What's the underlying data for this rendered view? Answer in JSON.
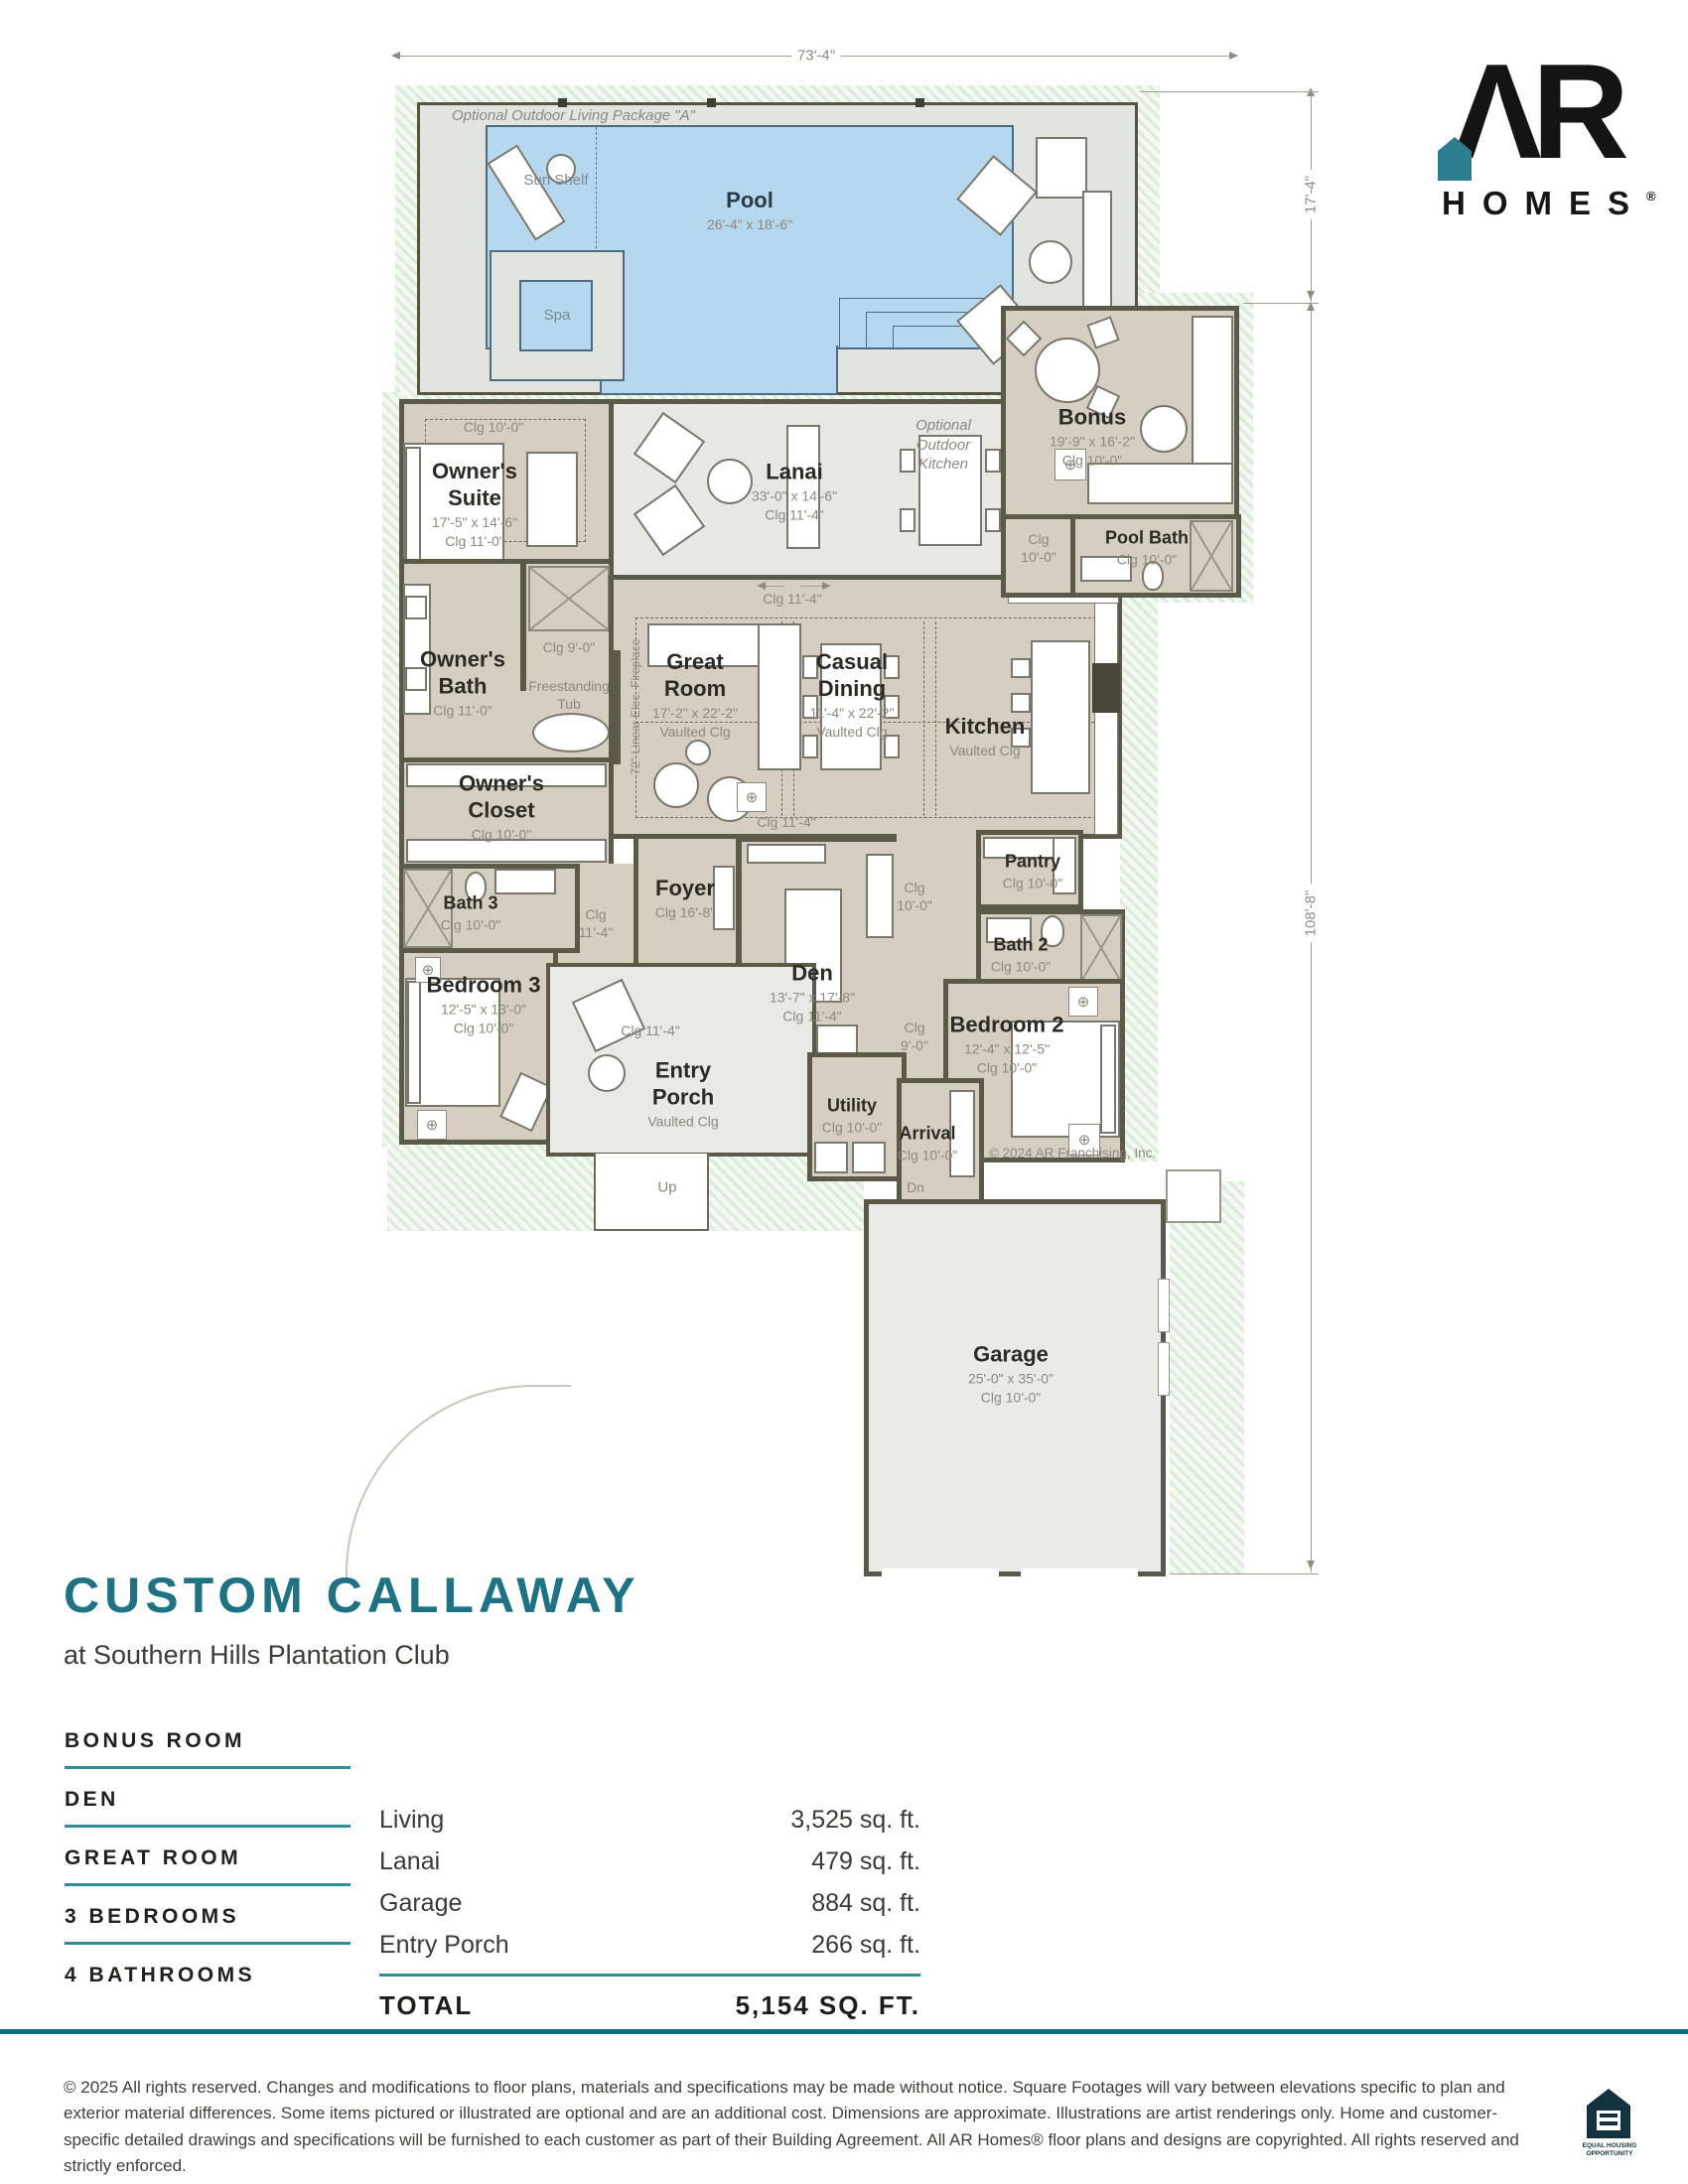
{
  "brand": {
    "monogram": "ΛR",
    "word": "HOMES",
    "registered": "®"
  },
  "dimensions": {
    "top": "73'-4\"",
    "right_upper": "17'-4\"",
    "right_lower": "108'-8\""
  },
  "plan": {
    "package_label": "Optional Outdoor Living Package \"A\"",
    "copyright": "© 2024 AR Franchising, Inc.",
    "rooms": {
      "pool": {
        "name": "Pool",
        "dims": "26'-4\" x 18'-6\""
      },
      "spa": {
        "name": "Spa"
      },
      "sun_shelf": {
        "name": "Sun Shelf"
      },
      "owners_suite": {
        "name": "Owner's Suite",
        "dims": "17'-5\" x 14'-6\"",
        "clg": "Clg 11'-0\""
      },
      "lanai": {
        "name": "Lanai",
        "dims": "33'-0\" x 14'-6\"",
        "clg": "Clg 11'-4\""
      },
      "bonus": {
        "name": "Bonus",
        "dims": "19'-9\" x 16'-2\"",
        "clg": "Clg 10'-0\""
      },
      "pool_bath": {
        "name": "Pool Bath",
        "clg": "Clg 10'-0\""
      },
      "owners_bath": {
        "name": "Owner's Bath",
        "clg": "Clg 11'-0\""
      },
      "owners_closet": {
        "name": "Owner's Closet",
        "clg": "Clg 10'-0\""
      },
      "great_room": {
        "name": "Great Room",
        "dims": "17'-2\" x 22'-2\"",
        "clg": "Vaulted Clg"
      },
      "casual_dining": {
        "name": "Casual Dining",
        "dims": "11'-4\" x 22'-2\"",
        "clg": "Vaulted Clg"
      },
      "kitchen": {
        "name": "Kitchen",
        "clg": "Vaulted Clg"
      },
      "pantry": {
        "name": "Pantry",
        "clg": "Clg 10'-0\""
      },
      "foyer": {
        "name": "Foyer",
        "clg": "Clg 16'-8\""
      },
      "bath_2": {
        "name": "Bath 2",
        "clg": "Clg 10'-0\""
      },
      "bath_3": {
        "name": "Bath 3",
        "clg": "Clg 10'-0\""
      },
      "bedroom_2": {
        "name": "Bedroom 2",
        "dims": "12'-4\" x 12'-5\"",
        "clg": "Clg 10'-0\""
      },
      "bedroom_3": {
        "name": "Bedroom 3",
        "dims": "12'-5\" x 13'-0\"",
        "clg": "Clg 10'-0\""
      },
      "den": {
        "name": "Den",
        "dims": "13'-7\" x 17'-8\"",
        "clg": "Clg 11'-4\""
      },
      "entry_porch": {
        "name": "Entry Porch",
        "clg": "Vaulted Clg"
      },
      "utility": {
        "name": "Utility",
        "clg": "Clg 10'-0\""
      },
      "arrival": {
        "name": "Arrival",
        "clg": "Clg 10'-0\""
      },
      "garage": {
        "name": "Garage",
        "dims": "25'-0\" x 35'-0\"",
        "clg": "Clg 10'-0\""
      }
    },
    "notes": {
      "suite_clg": "Clg 10'-0\"",
      "walkway_clg": "Clg 11'-4\"",
      "outdoor_kitchen": "Optional Outdoor Kitchen",
      "bonus_hall_clg": "Clg 10'-0\"",
      "tub_clg": "Clg 9'-0\"",
      "tub": "Freestanding Tub",
      "fireplace": "72\" Linear Elec. Fireplace",
      "gallery_clg": "Clg 11'-4\"",
      "hall_foyer_clg": "Clg 11'-4\"",
      "hall_pantry_clg": "Clg 10'-0\"",
      "hall_bedroom2_clg": "Clg 9'-0\"",
      "porch_walk_clg": "Clg 11'-4\"",
      "up": "Up",
      "dn": "Dn"
    }
  },
  "icons": {
    "ceiling_fan": "⊕"
  },
  "title_block": {
    "title": "CUSTOM CALLAWAY",
    "subtitle": "at Southern Hills Plantation Club"
  },
  "features": [
    "BONUS ROOM",
    "DEN",
    "GREAT ROOM",
    "3 BEDROOMS",
    "4 BATHROOMS"
  ],
  "area_table": {
    "rows": [
      {
        "label": "Living",
        "value": "3,525 sq. ft."
      },
      {
        "label": "Lanai",
        "value": "479 sq. ft."
      },
      {
        "label": "Garage",
        "value": "884 sq. ft."
      },
      {
        "label": "Entry Porch",
        "value": "266 sq. ft."
      }
    ],
    "total_label": "TOTAL",
    "total_value": "5,154 SQ. FT."
  },
  "footer": {
    "disclaimer": "© 2025 All rights reserved. Changes and modifications to floor plans, materials and specifications may be made without notice. Square Footages will vary between elevations specific to plan and exterior material differences. Some items pictured or illustrated are optional and are an additional cost. Dimensions are approximate. Illustrations are artist renderings only. Home and customer-specific detailed drawings and specifications will be furnished to each customer as part of their Building Agreement. All AR Homes® floor plans and designs are copyrighted. All rights reserved and strictly enforced.",
    "equal_housing": "EQUAL HOUSING OPPORTUNITY"
  }
}
